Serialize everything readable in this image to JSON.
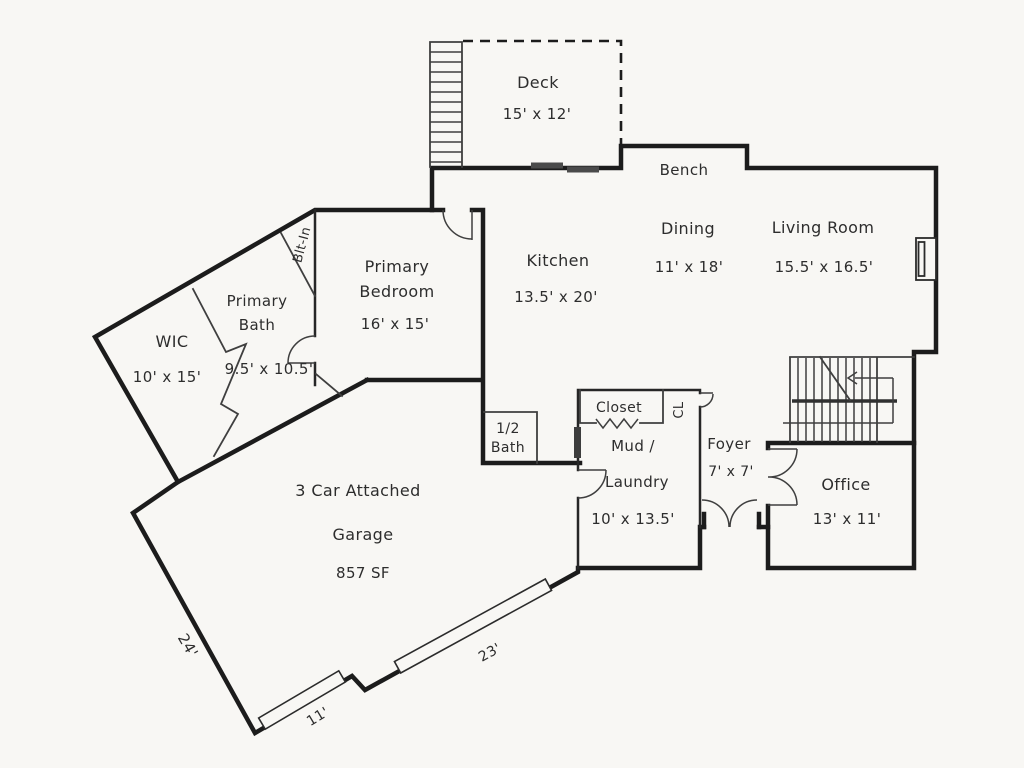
{
  "plan_title": "Main floor plan",
  "colors": {
    "background": "#f8f7f4",
    "wall": "#1c1c1c",
    "thin_line": "#3f3f3f",
    "text": "#2d2d2d"
  },
  "rooms": {
    "deck": {
      "name": "Deck",
      "dims": "15' x 12'"
    },
    "bench": {
      "name": "Bench"
    },
    "dining": {
      "name": "Dining",
      "dims": "11' x 18'"
    },
    "living": {
      "name": "Living Room",
      "dims": "15.5' x 16.5'"
    },
    "kitchen": {
      "name": "Kitchen",
      "dims": "13.5' x 20'"
    },
    "bedroom": {
      "line1": "Primary",
      "line2": "Bedroom",
      "dims": "16' x 15'"
    },
    "bath": {
      "line1": "Primary",
      "line2": "Bath",
      "dims": "9.5' x 10.5'"
    },
    "wic": {
      "name": "WIC",
      "dims": "10' x 15'"
    },
    "bltin": {
      "name": "Blt-In"
    },
    "halfbath": {
      "line1": "1/2",
      "line2": "Bath"
    },
    "closet": {
      "name": "Closet"
    },
    "cl": {
      "name": "CL"
    },
    "mud": {
      "line1": "Mud /",
      "line2": "Laundry",
      "dims": "10' x 13.5'"
    },
    "foyer": {
      "name": "Foyer",
      "dims": "7' x 7'"
    },
    "office": {
      "name": "Office",
      "dims": "13' x 11'"
    },
    "garage": {
      "line1": "3 Car Attached",
      "line2": "Garage",
      "line3": "857 SF"
    }
  },
  "dimensions": {
    "garage_left_wall": "24'",
    "garage_door_small": "11'",
    "garage_door_large": "23'"
  }
}
